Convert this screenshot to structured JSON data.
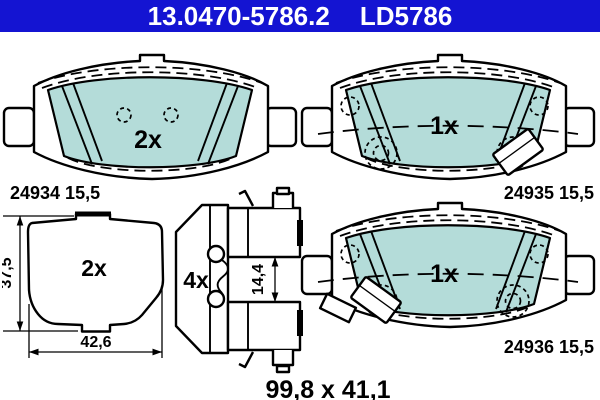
{
  "header": {
    "part_number": "13.0470-5786.2",
    "variant_code": "LD5786",
    "background": "#1414d2",
    "text_color": "#ffffff"
  },
  "colors": {
    "pad_friction_fill": "#b4dcd9",
    "outline": "#000000",
    "page_background": "#ffffff"
  },
  "pads": {
    "top_left": {
      "quantity": "2x",
      "part_label": "24934 15,5"
    },
    "top_right": {
      "quantity": "1x",
      "part_label": "24935 15,5"
    },
    "bottom_right": {
      "quantity": "1x",
      "part_label": "24936 15,5"
    }
  },
  "shim": {
    "quantity": "2x",
    "height_mm": "37,5",
    "width_mm": "42,6"
  },
  "clip": {
    "quantity": "4x",
    "gap_mm": "14,4"
  },
  "kit_dimensions_mm": "99,8 x 41,1"
}
